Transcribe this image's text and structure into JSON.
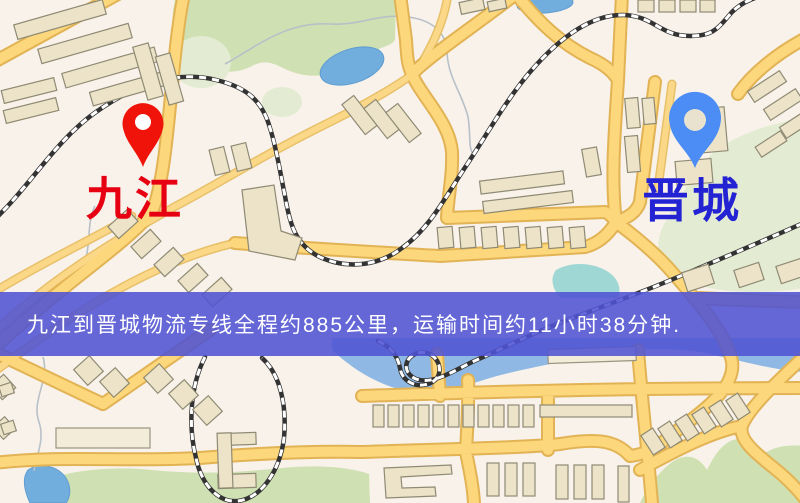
{
  "banner": {
    "text": "九江到晋城物流专线全程约885公里，运输时间约11小时38分钟.",
    "background_color": "#5053d3",
    "text_color": "#ffffff",
    "route": {
      "origin": "九江",
      "destination": "晋城",
      "distance": "约885公里",
      "duration": "约11小时38分钟"
    }
  },
  "markers": [
    {
      "name": "九江",
      "role": "origin",
      "pin_color": "#f0130a",
      "pin_hole_color": "#ffffff",
      "label_color": "#e60012"
    },
    {
      "name": "晋城",
      "role": "destination",
      "pin_color": "#4b8cf5",
      "pin_hole_color": "#e9e2cf",
      "label_color": "#2323d4"
    }
  ],
  "map_palette": {
    "background": "#f8f2ea",
    "road_fill": "#fcd77b",
    "road_edge": "#e2b355",
    "railway": "#333333",
    "water_band": "#8fb9e4",
    "pond": "#72aedd",
    "park": "#cfe0b2",
    "teal_patch": "#8ed2cf",
    "building_fill": "#ece3c8",
    "building_stroke": "#8f8a74"
  }
}
